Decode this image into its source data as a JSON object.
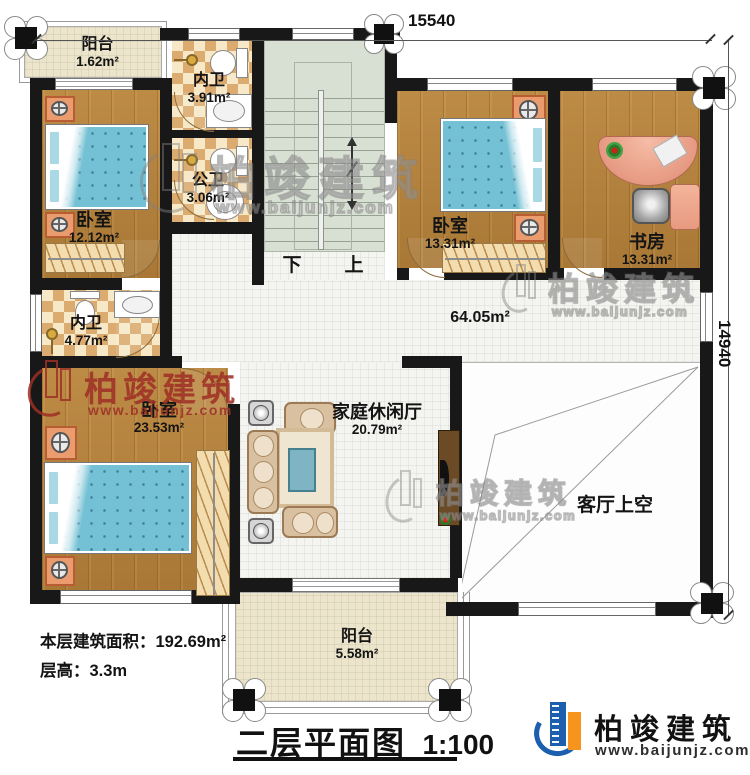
{
  "dimensions": {
    "top": "15540",
    "right": "14940"
  },
  "rooms": [
    {
      "id": "balcony-top",
      "name": "阳台",
      "area": "1.62m²"
    },
    {
      "id": "bath-inner-top",
      "name": "内卫",
      "area": "3.91m²"
    },
    {
      "id": "bath-public",
      "name": "公卫",
      "area": "3.06m²"
    },
    {
      "id": "bedroom-1",
      "name": "卧室",
      "area": "12.12m²"
    },
    {
      "id": "bedroom-2",
      "name": "卧室",
      "area": "13.31m²"
    },
    {
      "id": "study",
      "name": "书房",
      "area": "13.31m²"
    },
    {
      "id": "bath-inner-mid",
      "name": "内卫",
      "area": "4.77m²"
    },
    {
      "id": "bedroom-master",
      "name": "卧室",
      "area": "23.53m²"
    },
    {
      "id": "family-hall",
      "name": "家庭休闲厅",
      "area": "20.79m²"
    },
    {
      "id": "hallway",
      "name": "",
      "area": "64.05m²"
    },
    {
      "id": "living-void",
      "name": "客厅上空",
      "area": ""
    },
    {
      "id": "balcony-bottom",
      "name": "阳台",
      "area": "5.58m²"
    }
  ],
  "stairs": {
    "down_label": "下",
    "up_label": "上"
  },
  "notes": {
    "area_line": "本层建筑面积：192.69m²",
    "height_line": "层高：3.3m"
  },
  "footer": {
    "plan_title": "二层平面图",
    "scale": "1:100"
  },
  "brand": {
    "company": "柏竣建筑",
    "website": "www.baijunjz.com"
  },
  "watermark": {
    "text": "柏竣建筑",
    "url": "www.baijunjz.com"
  },
  "colors": {
    "wall": "#181818",
    "wood": "#b5823c",
    "stair": "#d8dfd3",
    "checker_dark": "#dcab6f",
    "watermark_red": "#9e3026",
    "logo_blue": "#1b5fae",
    "logo_orange": "#f7941d"
  }
}
